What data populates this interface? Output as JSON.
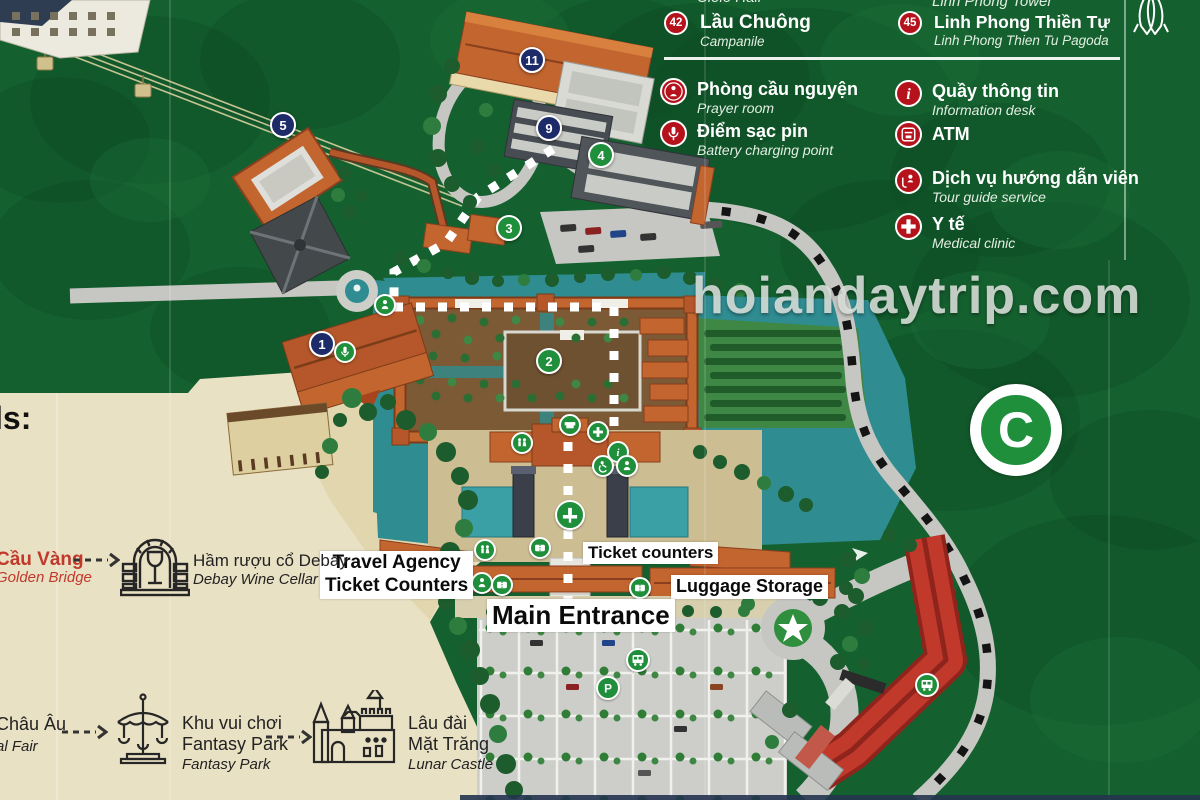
{
  "watermark": "hoiandaytrip.com",
  "zone_badge": "C",
  "legend_numbered": [
    {
      "num": "42",
      "vi": "Lầu Chuông",
      "en": "Campanile",
      "above_en": "Cielo Hall"
    },
    {
      "num": "45",
      "vi": "Linh Phong Thiền Tự",
      "en": "Linh Phong Thien Tu Pagoda",
      "above_en": "Linh Phong Tower"
    }
  ],
  "legend_services": [
    {
      "vi": "Phòng cầu nguyện",
      "en": "Prayer room"
    },
    {
      "vi": "Điểm sạc pin",
      "en": "Battery charging point"
    },
    {
      "vi": "Quầy thông tin",
      "en": "Information desk"
    },
    {
      "vi": "ATM",
      "en": ""
    },
    {
      "vi": "Dịch vụ hướng dẫn viên",
      "en": "Tour guide service"
    },
    {
      "vi": "Y tế",
      "en": "Medical clinic"
    }
  ],
  "legend_attractions": {
    "heading_partial": "ls:",
    "golden_bridge_vi": "Cầu Vàng",
    "golden_bridge_en": "Golden Bridge",
    "wine_cellar_vi": "Hầm rượu cổ Debay",
    "wine_cellar_en": "Debay Wine Cellar",
    "carnival_vi_partial": "Châu Âu",
    "carnival_en_partial": "al Fair",
    "fantasy_vi1": "Khu vui chơi",
    "fantasy_vi2": "Fantasy Park",
    "fantasy_en": "Fantasy Park",
    "lunar_vi1": "Lâu đài",
    "lunar_vi2": "Mặt Trăng",
    "lunar_en": "Lunar Castle"
  },
  "map_labels": {
    "travel_agency_1": "Travel Agency",
    "travel_agency_2": "Ticket Counters",
    "ticket_counters": "Ticket counters",
    "luggage_storage": "Luggage Storage",
    "main_entrance": "Main Entrance"
  },
  "map_markers": [
    {
      "num": "11"
    },
    {
      "num": "9"
    },
    {
      "num": "5"
    },
    {
      "num": "4"
    },
    {
      "num": "3"
    },
    {
      "num": "1"
    },
    {
      "num": "2"
    }
  ],
  "colors": {
    "forest": "#14612f",
    "legend_red": "#b5121b",
    "marker_navy": "#1d2b69",
    "marker_green": "#1f8f3c",
    "water": "#2f8c91",
    "road": "#c6c7c2",
    "roof_orange": "#c2652f",
    "building_red": "#b8352b",
    "paper": "#e9e1c4"
  }
}
